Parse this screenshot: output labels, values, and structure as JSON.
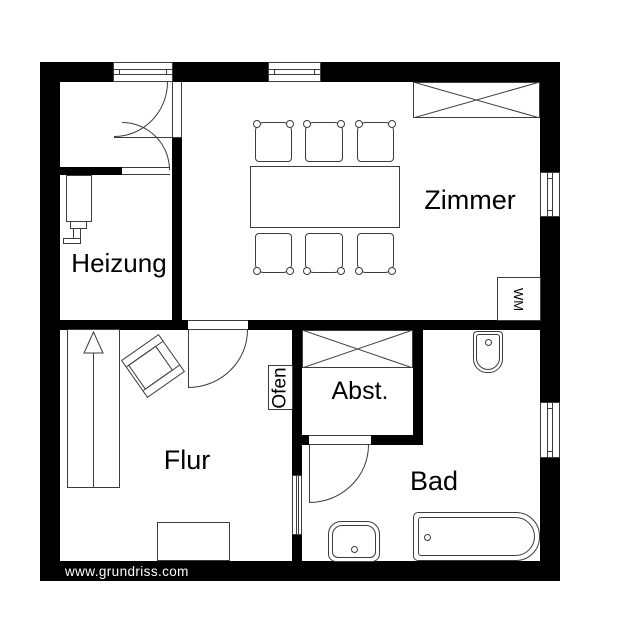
{
  "watermark": "www.grundriss.com",
  "rooms": {
    "zimmer": "Zimmer",
    "heizung": "Heizung",
    "flur": "Flur",
    "bad": "Bad",
    "abstellraum": "Abst."
  },
  "labels": {
    "ofen": "Ofen",
    "waschmaschine": "WM"
  },
  "colors": {
    "wall": "#000000",
    "thin_line": "#3c3c3c",
    "background": "#ffffff",
    "watermark_text": "#ffffff"
  }
}
